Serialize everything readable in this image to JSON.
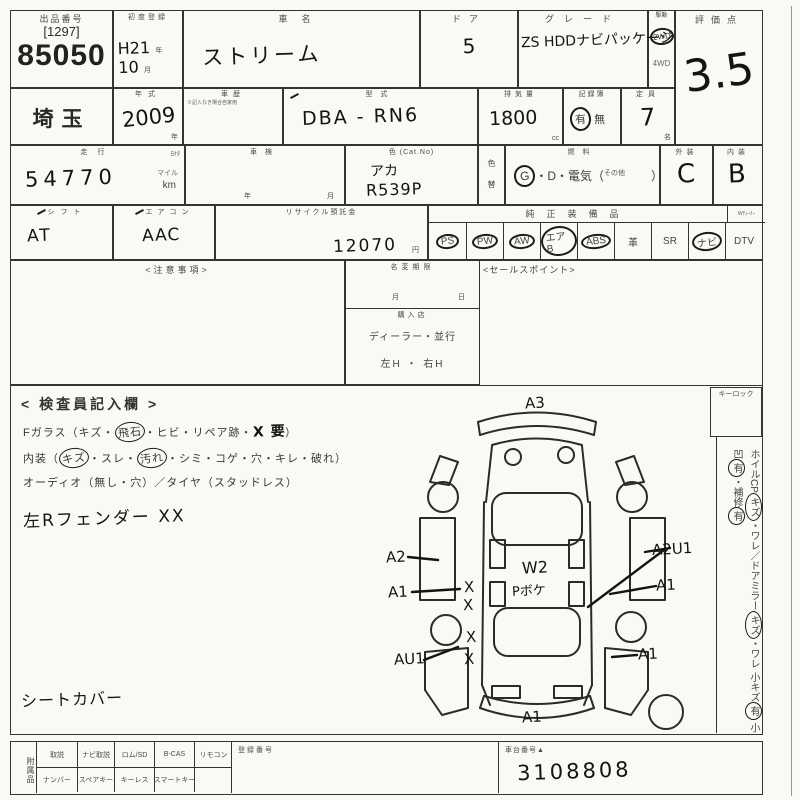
{
  "colors": {
    "paper": "#faf9f4",
    "line": "#35342f",
    "ink": "#15140f",
    "print": "#4a4a46"
  },
  "lot": {
    "label": "出品番号",
    "bracket": "[1297]",
    "number": "85050"
  },
  "region": {
    "value": "埼玉"
  },
  "first_reg": {
    "label": "初度登録",
    "year_value": "H21",
    "year_unit": "年",
    "month_value": "10",
    "month_unit": "月"
  },
  "model_year": {
    "label": "年式",
    "value": "2009",
    "unit": "年"
  },
  "history": {
    "label": "車歴",
    "note": "※記入なき場合自家用"
  },
  "car_name": {
    "label": "車名",
    "value": "ストリーム"
  },
  "doors": {
    "label": "ドア",
    "value": "5"
  },
  "grade": {
    "label": "グレード",
    "value": "ZS HDDナビパッケージ"
  },
  "drive": {
    "label": "駆動",
    "opt_2wd": "2WD",
    "opt_4wd": "4WD"
  },
  "score": {
    "label": "評価点",
    "value": "3.5"
  },
  "model_code": {
    "label": "型式",
    "value": "DBA - RN6"
  },
  "displacement": {
    "label": "排気量",
    "value": "1800",
    "unit": "cc"
  },
  "record_book": {
    "label": "記録簿",
    "yes": "有",
    "no": "無"
  },
  "capacity": {
    "label": "定員",
    "value": "7",
    "unit": "名"
  },
  "mileage": {
    "label": "走行",
    "digits_note": "5ｹﾀ",
    "value": "54770",
    "unit_mile": "マイル",
    "unit_km": "km"
  },
  "shaken": {
    "label": "車検",
    "year_unit": "年",
    "month_unit": "月"
  },
  "color": {
    "label": "色 (Cat.No)",
    "line1": "アカ",
    "line2": "R539P"
  },
  "color_change": {
    "top": "色",
    "bottom": "替"
  },
  "fuel": {
    "label": "燃料",
    "g": "G",
    "mid": "・D・電気（",
    "other": "その他",
    "close": "）"
  },
  "exterior": {
    "label": "外装",
    "value": "C"
  },
  "interior_grade": {
    "label": "内装",
    "value": "B"
  },
  "shift": {
    "label": "シフト",
    "value": "AT"
  },
  "aircon": {
    "label": "エアコン",
    "value": "AAC"
  },
  "recycle": {
    "label": "リサイクル預託金",
    "value": "12070",
    "unit": "円"
  },
  "equipment": {
    "label": "純正装備品",
    "tuner_note": "Wﾁｭｰﾅｰ"
  },
  "equip_items": [
    {
      "text": "PS",
      "circled": true
    },
    {
      "text": "PW",
      "circled": true
    },
    {
      "text": "AW",
      "circled": true
    },
    {
      "text": "エアB",
      "circled": true
    },
    {
      "text": "ABS",
      "circled": true
    },
    {
      "text": "革",
      "circled": false
    },
    {
      "text": "SR",
      "circled": false
    },
    {
      "text": "ナビ",
      "circled": true
    },
    {
      "text": "DTV",
      "circled": false
    }
  ],
  "caution": {
    "label": "<注意事項>"
  },
  "sales_point": {
    "label": "<セールスポイント>"
  },
  "name_change": {
    "label": "名変期限",
    "month": "月",
    "day": "日",
    "purchase_label": "購入店",
    "purchase_value": "ディーラー・並行",
    "steering": "左H ・ 右H"
  },
  "inspection": {
    "heading": "< 検査員記入欄 >",
    "fglass_p1": "Fガラス（キズ・",
    "fglass_c1": "飛石",
    "fglass_p2": "・ヒビ・リペア跡・",
    "fglass_hand": "X 要",
    "fglass_p3": "）",
    "interior_p1": "内装（",
    "interior_c1": "キズ",
    "interior_p2": "・スレ・",
    "interior_c2": "汚れ",
    "interior_p3": "・シミ・コゲ・穴・キレ・破れ）",
    "audio_line": "オーディオ（無し・穴）／タイヤ（スタッドレス）",
    "hand_note1": "左Rフェンダー XX",
    "hand_note2": "シートカバー",
    "keylock_label": "キーロック",
    "col1_p1": "ホイルCP",
    "col1_c1": "キズ",
    "col1_p2": "・ワレ／ドアミラー",
    "col1_c2": "キズ",
    "col1_p3": "・ワレ",
    "col2_p1": "小キズ",
    "col2_c1": "有",
    "col2_p2": " 小凹",
    "col2_c2": "有",
    "col2_p3": "・補修",
    "col2_c3": "有"
  },
  "diagram": {
    "a3": "A3",
    "a2": "A2",
    "a1_left": "A1",
    "au1": "AU1",
    "a1_bottom": "A1",
    "a1_right": "A1",
    "a1_right_mid": "A1",
    "a2u1": "A2U1",
    "w2": "W2",
    "p_note": "Pボケ",
    "x_mark": "X"
  },
  "bottom_strip": {
    "accessories_label": "附属品",
    "row1": [
      "取説",
      "ナビ取説",
      "ロム/SD",
      "B-CAS",
      "リモコン"
    ],
    "row2": [
      "ナンバー",
      "スペアキー",
      "キーレス",
      "スマートキー",
      ""
    ],
    "reg_label": "登録番号",
    "chassis_label": "車台番号▲",
    "chassis_value": "3108808"
  }
}
